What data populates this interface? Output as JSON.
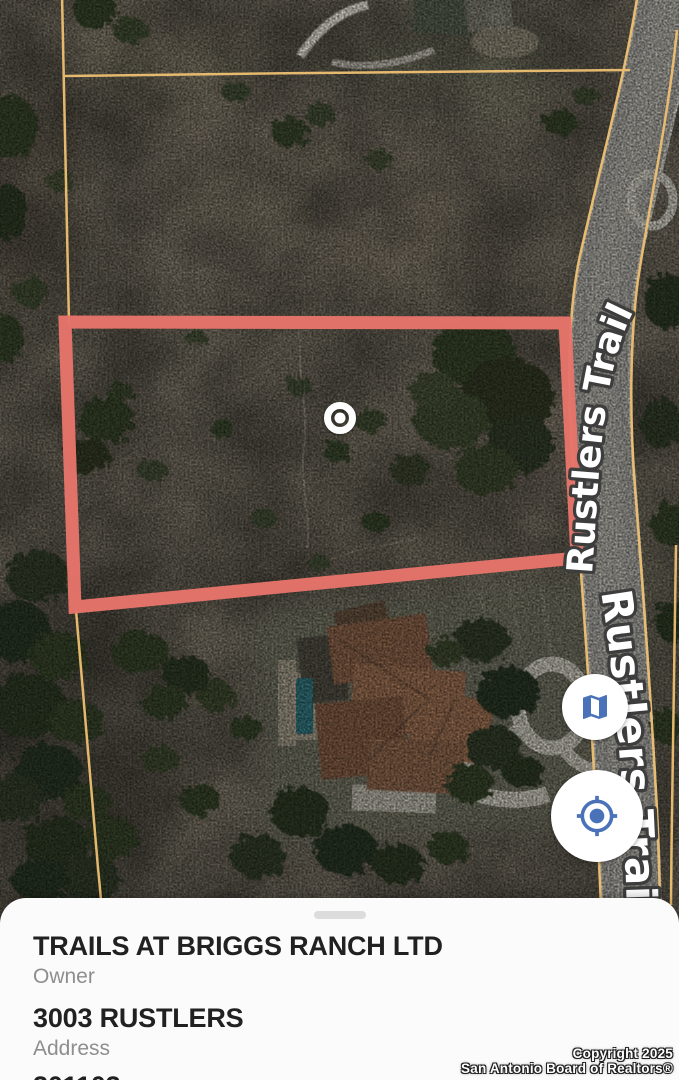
{
  "map": {
    "road_label_upper": "Rustlers Trail",
    "road_label_lower": "Rustlers Trail",
    "parcel_outline_color": "#e5746a",
    "boundary_line_color": "#eec072",
    "marker_icon": "selected-location-ring-marker"
  },
  "controls": {
    "map_type_icon": "map-icon",
    "my_location_icon": "my-location-icon",
    "icon_color": "#4a72b8"
  },
  "sheet": {
    "owner_value": "TRAILS AT BRIGGS RANCH LTD",
    "owner_label": "Owner",
    "address_value": "3003 RUSTLERS",
    "address_label": "Address",
    "geo_id_partial": "301103"
  },
  "attribution": {
    "line1": "Copyright 2025",
    "line2": "San Antonio Board of Realtors®"
  }
}
